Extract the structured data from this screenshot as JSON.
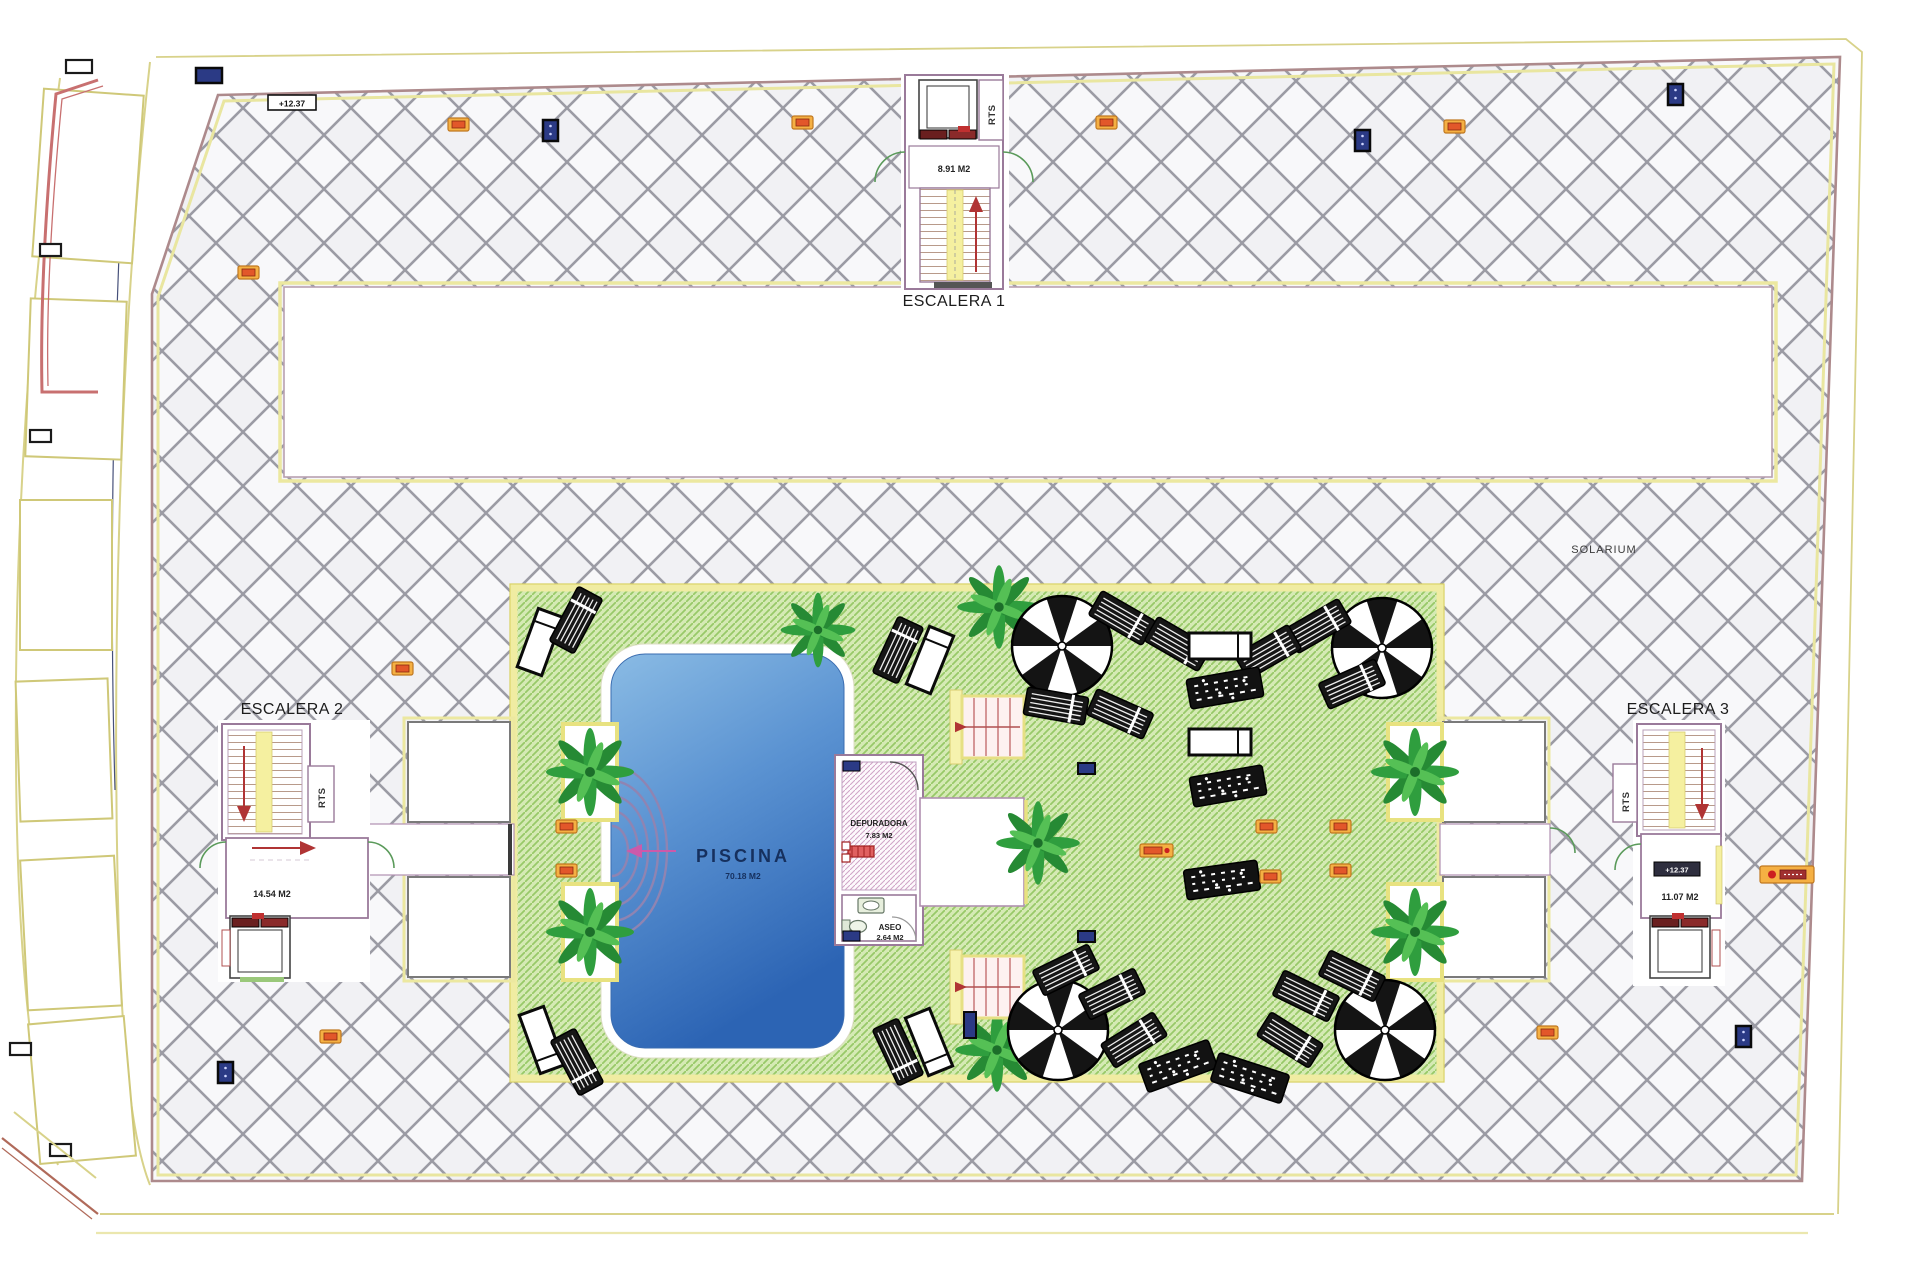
{
  "plan": {
    "solarium_label": "SOLARIUM",
    "elevation_marker": "+12.37",
    "pool": {
      "name": "PISCINA",
      "area": "70.18 M2"
    },
    "depuradora": {
      "name": "DEPURADORA",
      "area": "7.83 M2"
    },
    "aseo": {
      "name": "ASEO",
      "area": "2.64 M2"
    },
    "stairs": {
      "escalera1": {
        "label": "ESCALERA 1",
        "area": "8.91 M2",
        "riser_label": "RTS"
      },
      "escalera2": {
        "label": "ESCALERA 2",
        "area": "14.54 M2",
        "riser_label": "RTS"
      },
      "escalera3": {
        "label": "ESCALERA 3",
        "area": "11.07 M2",
        "riser_label": "RTS",
        "elevation_marker": "+12.37"
      }
    },
    "icons": {
      "palm": "palm-tree-icon",
      "parasol": "parasol-icon",
      "lounger_dark": "sun-lounger-dark-icon",
      "lounger_white": "sun-lounger-white-icon",
      "door_marker": "door-marker-icon",
      "light_marker": "orange-fixture-icon",
      "pool_steps": "pool-steps-icon"
    },
    "colors": {
      "deck_hatch_line": "#9b9ba4",
      "deck_background": "#f8f8fa",
      "green_background": "#d5eab4",
      "green_hatch_line": "#98c968",
      "border_yellow": "#f0eca2",
      "wall_outline": "#9a7a9a",
      "pool_light": "#8abbe4",
      "pool_deep": "#2c64b4",
      "stair_yellow": "#f5f0a0",
      "arrow_red": "#b03434",
      "badge_orange": "#f5b043",
      "badge_blue": "#2b3a85",
      "parasol_black": "#141414"
    }
  }
}
